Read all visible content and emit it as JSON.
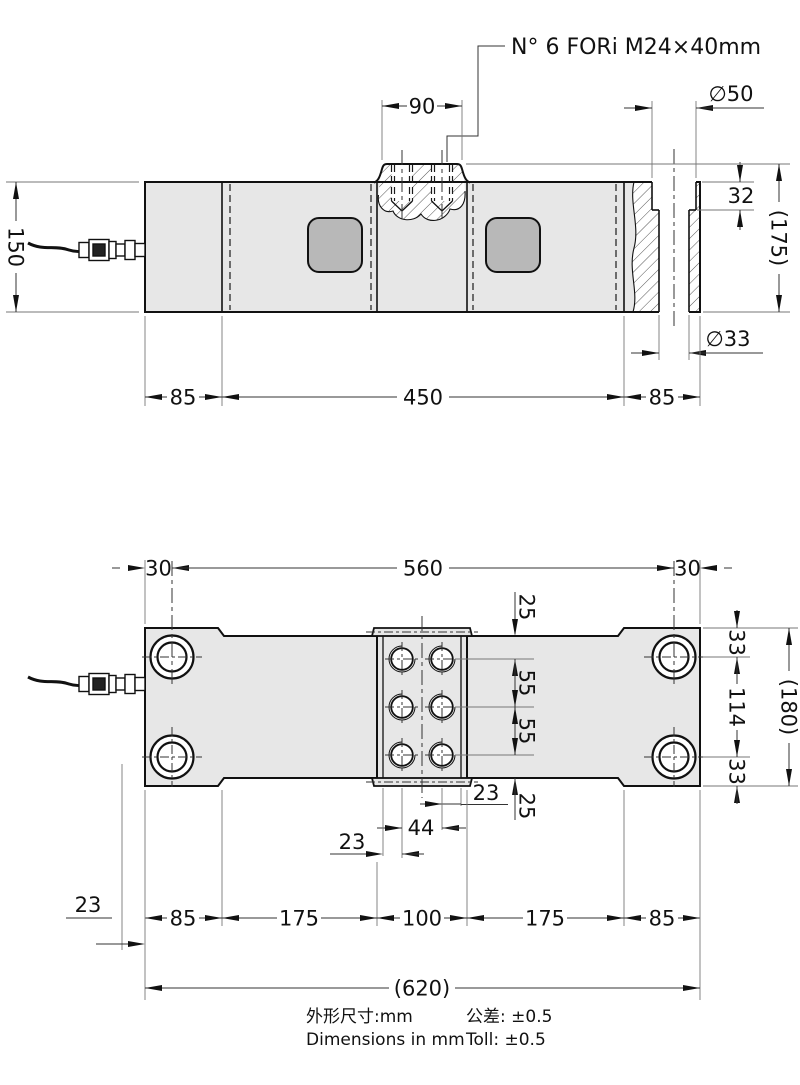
{
  "note": "N° 6 FORi M24×40mm",
  "side_view": {
    "boss_width": "90",
    "counterbore_dia": "∅50",
    "counterbore_depth": "32",
    "overall_height": "(175)",
    "body_height": "150",
    "hole_dia": "∅33",
    "seg_left": "85",
    "seg_center": "450",
    "seg_right": "85"
  },
  "plan_view": {
    "edge_offset_left": "30",
    "hole_span": "560",
    "edge_offset_right": "30",
    "recess_to_row_top": "25",
    "row_top": "33",
    "row_span": "114",
    "row_bottom": "33",
    "overall_width": "(180)",
    "pitch_upper": "55",
    "pitch_lower": "55",
    "col_to_edge_right": "23",
    "row_to_recess_bottom": "25",
    "col_pitch": "44",
    "edge_to_col_left": "23",
    "seg1": "85",
    "seg2": "175",
    "seg3": "100",
    "seg4": "175",
    "seg5": "85",
    "cable_offset": "23",
    "overall_length": "(620)"
  },
  "footer": {
    "dims_cn": "外形尺寸:mm",
    "tol_cn": "公差: ±0.5",
    "dims_en": "Dimensions in mm",
    "tol_en": "Toll: ±0.5"
  }
}
